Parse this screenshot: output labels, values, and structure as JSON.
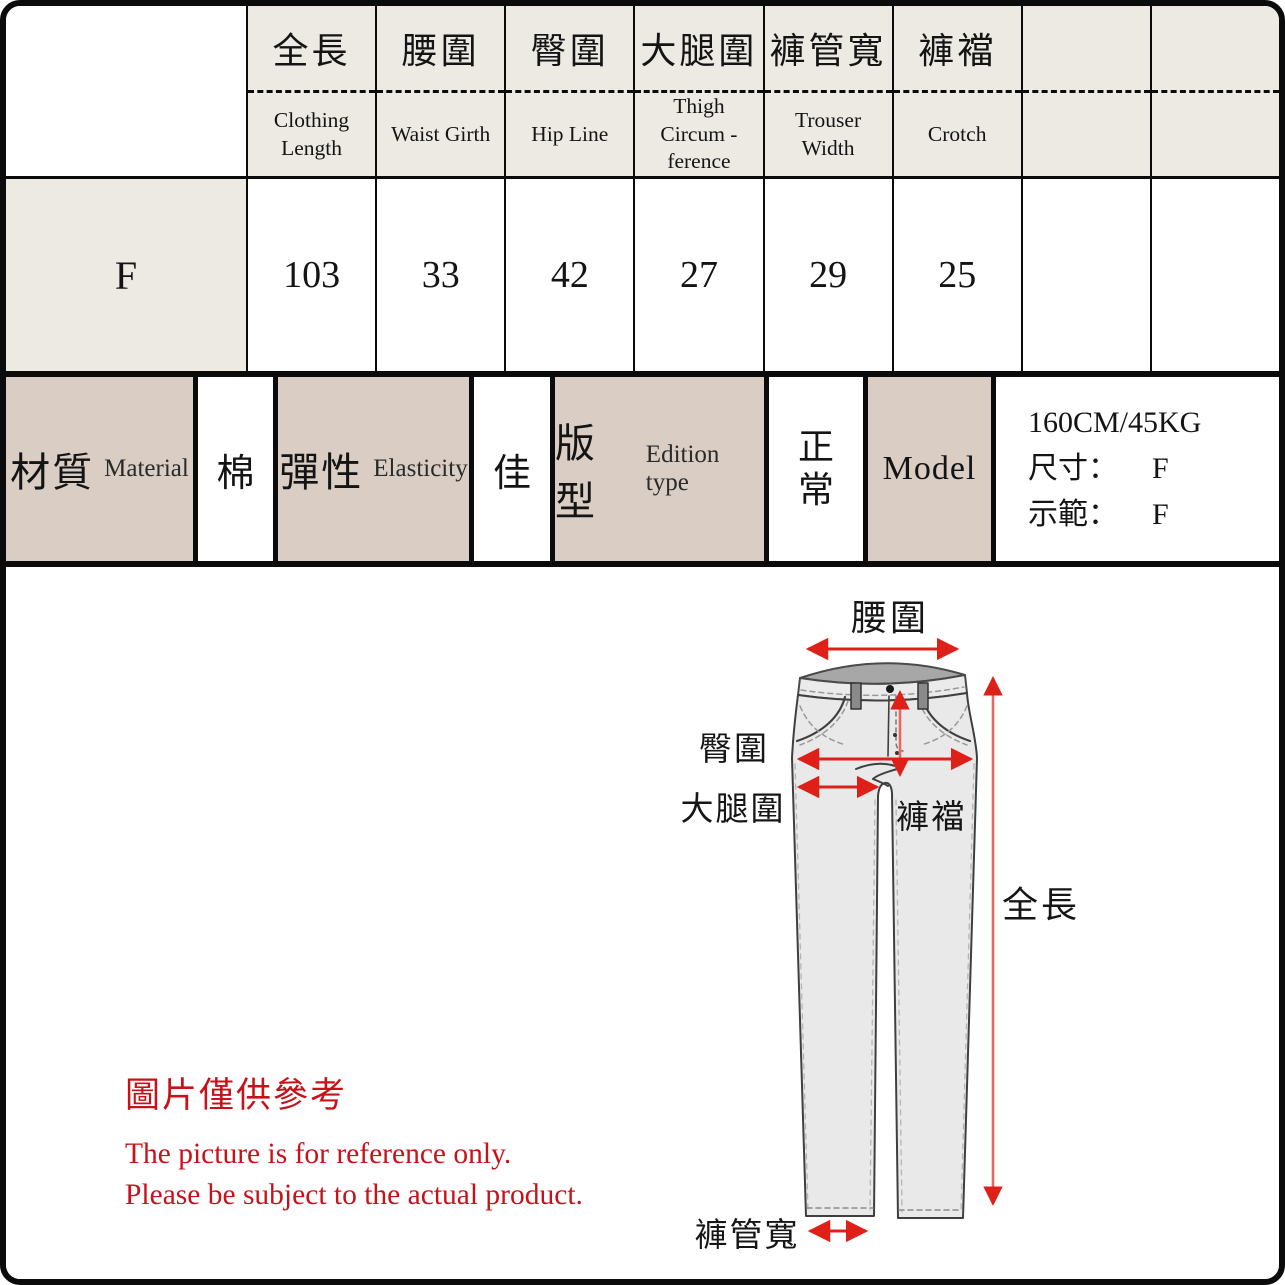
{
  "table": {
    "columns": [
      {
        "zh": "全長",
        "en": "Clothing Length"
      },
      {
        "zh": "腰圍",
        "en": "Waist Girth"
      },
      {
        "zh": "臀圍",
        "en": "Hip Line"
      },
      {
        "zh": "大腿圍",
        "en": "Thigh Circum -ference"
      },
      {
        "zh": "褲管寬",
        "en": "Trouser Width"
      },
      {
        "zh": "褲襠",
        "en": "Crotch"
      },
      {
        "zh": "",
        "en": ""
      },
      {
        "zh": "",
        "en": ""
      }
    ],
    "row_label": "F",
    "values": [
      "103",
      "33",
      "42",
      "27",
      "29",
      "25",
      "",
      ""
    ]
  },
  "info_row": {
    "material_zh": "材質",
    "material_en": "Material",
    "material_value": "棉",
    "elasticity_zh": "彈性",
    "elasticity_en": "Elasticity",
    "elasticity_value": "佳",
    "edition_zh": "版型",
    "edition_en": "Edition type",
    "edition_value": "正常",
    "model_label": "Model",
    "model_spec": "160CM/45KG",
    "size_label": "尺寸：",
    "size_value": "F",
    "demo_label": "示範：",
    "demo_value": "F"
  },
  "diagram": {
    "labels": {
      "waist": "腰圍",
      "hip": "臀圍",
      "thigh": "大腿圍",
      "crotch": "褲襠",
      "full_length": "全長",
      "leg_width": "褲管寬"
    }
  },
  "disclaimer": {
    "zh": "圖片僅供參考",
    "en1": "The picture is for reference only.",
    "en2": "Please be subject to the actual product."
  },
  "colors": {
    "header_bg": "#edeae4",
    "label_bg": "#d9cdc4",
    "arrow_red": "#df2018",
    "note_red": "#c8121a"
  }
}
